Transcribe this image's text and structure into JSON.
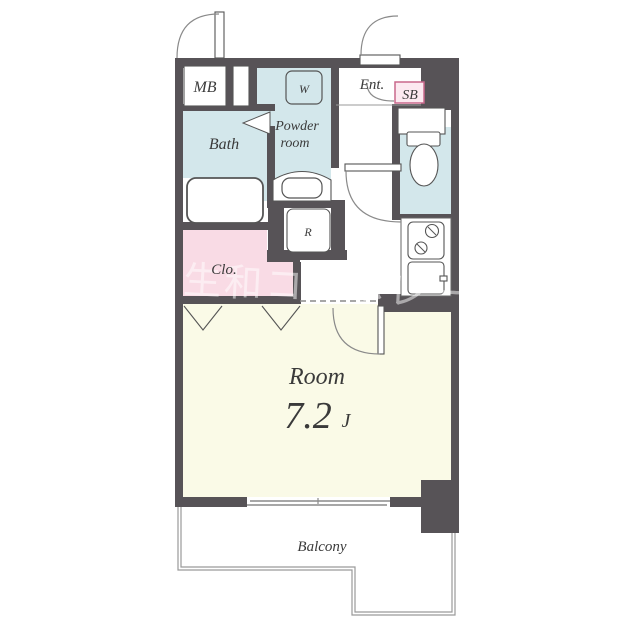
{
  "plan": {
    "title": "apartment-floor-plan",
    "rooms": {
      "meter_box": {
        "label": "MB"
      },
      "washer": {
        "label": "W"
      },
      "powder_room": {
        "label_line1": "Powder",
        "label_line2": "room"
      },
      "bath": {
        "label": "Bath"
      },
      "entrance": {
        "label": "Ent."
      },
      "shoe_box": {
        "label": "SB"
      },
      "closet": {
        "label": "Clo."
      },
      "refrigerator": {
        "label": "R"
      },
      "main_room": {
        "label": "Room",
        "size": "7.2",
        "size_unit": "J"
      },
      "balcony": {
        "label": "Balcony"
      }
    },
    "watermark": {
      "text": "生和コーポレーション"
    },
    "colors": {
      "wall": "#575357",
      "wet_area_blue": "#d3e7eb",
      "closet_pink": "#f9dbe5",
      "room_cream": "#fafae7",
      "sb_fill": "#fce9f0",
      "sb_border": "#c9688c",
      "sb_text": "#b0406d",
      "balcony_line": "#9a9a9a"
    }
  }
}
